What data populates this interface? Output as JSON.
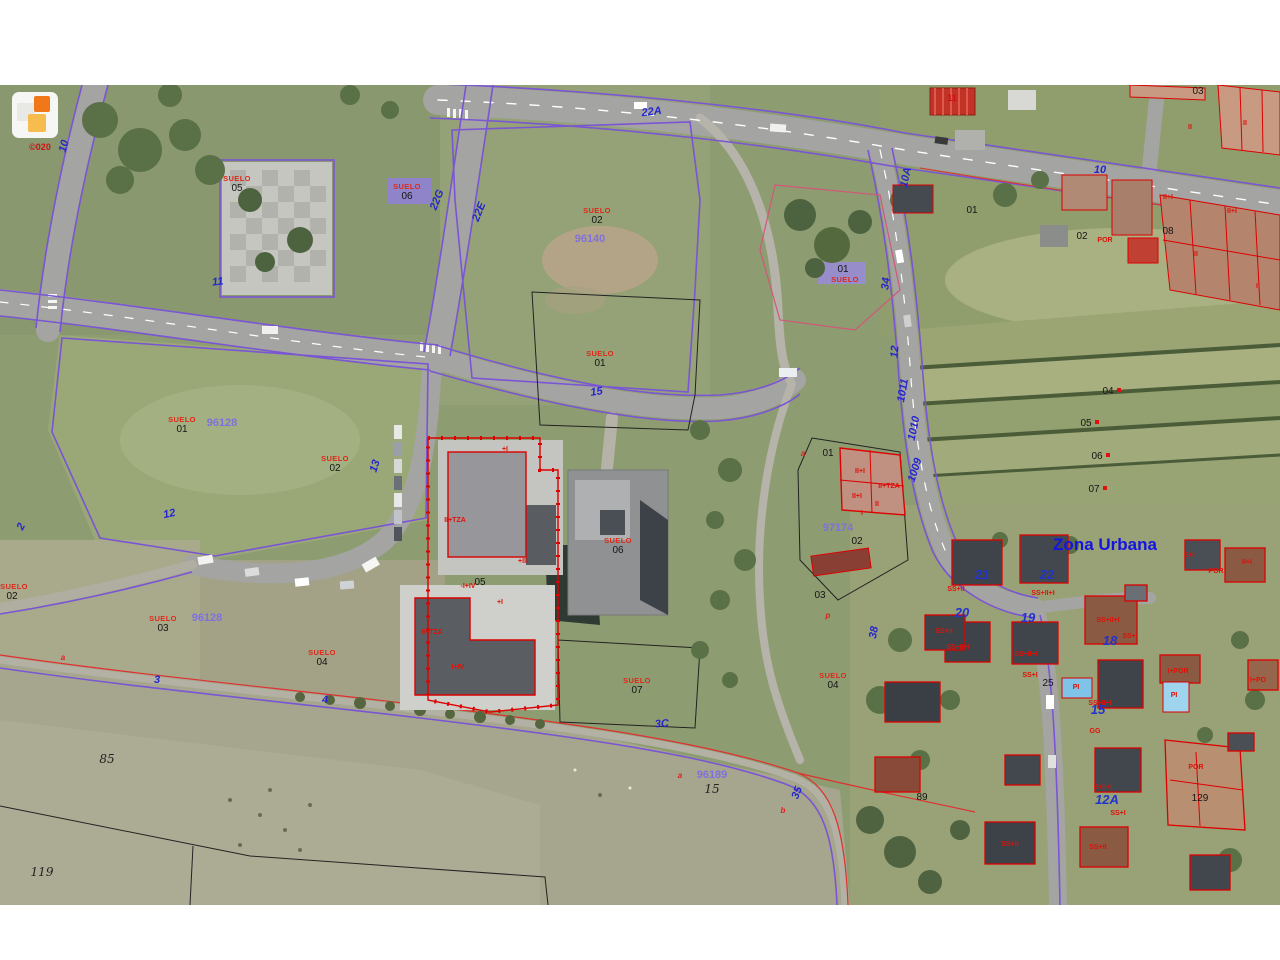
{
  "map_meta": {
    "type": "cadastral-aerial-orthophoto",
    "zone_text": "Zona Urbana",
    "copyright_mark": "©020",
    "colors": {
      "cadastral_line": "#7a55d4",
      "building_outline": "#e00000",
      "road_number": "#2626cc",
      "parcel_number_purple": "#8070dd",
      "suelo_red": "#e02818",
      "zona_urbana_blue": "#1414e0"
    }
  },
  "labels": [
    {
      "t": "©020",
      "x": 40,
      "y": 150,
      "c": "copyright",
      "n": "copyright"
    },
    {
      "t": "SUELO",
      "x": 237,
      "y": 181,
      "c": "suelo"
    },
    {
      "t": "05",
      "x": 237,
      "y": 191,
      "c": "num"
    },
    {
      "t": "SUELO",
      "x": 407,
      "y": 189,
      "c": "suelo"
    },
    {
      "t": "06",
      "x": 407,
      "y": 199,
      "c": "num"
    },
    {
      "t": "SUELO",
      "x": 597,
      "y": 213,
      "c": "suelo"
    },
    {
      "t": "02",
      "x": 597,
      "y": 223,
      "c": "num"
    },
    {
      "t": "SUELO",
      "x": 600,
      "y": 356,
      "c": "suelo"
    },
    {
      "t": "01",
      "x": 600,
      "y": 366,
      "c": "num"
    },
    {
      "t": "SUELO",
      "x": 182,
      "y": 422,
      "c": "suelo"
    },
    {
      "t": "01",
      "x": 182,
      "y": 432,
      "c": "num"
    },
    {
      "t": "SUELO",
      "x": 335,
      "y": 461,
      "c": "suelo"
    },
    {
      "t": "02",
      "x": 335,
      "y": 471,
      "c": "num"
    },
    {
      "t": "SUELO",
      "x": 163,
      "y": 621,
      "c": "suelo"
    },
    {
      "t": "03",
      "x": 163,
      "y": 631,
      "c": "num"
    },
    {
      "t": "SUELO",
      "x": 322,
      "y": 655,
      "c": "suelo"
    },
    {
      "t": "04",
      "x": 322,
      "y": 665,
      "c": "num"
    },
    {
      "t": "SUELO",
      "x": 14,
      "y": 589,
      "c": "suelo"
    },
    {
      "t": "02",
      "x": 12,
      "y": 599,
      "c": "num"
    },
    {
      "t": "SUELO",
      "x": 618,
      "y": 543,
      "c": "suelo"
    },
    {
      "t": "06",
      "x": 618,
      "y": 553,
      "c": "num"
    },
    {
      "t": "SUELO",
      "x": 637,
      "y": 683,
      "c": "suelo"
    },
    {
      "t": "07",
      "x": 637,
      "y": 693,
      "c": "num"
    },
    {
      "t": "SUELO",
      "x": 833,
      "y": 678,
      "c": "suelo"
    },
    {
      "t": "04",
      "x": 833,
      "y": 688,
      "c": "num"
    },
    {
      "t": "01",
      "x": 843,
      "y": 272,
      "c": "num"
    },
    {
      "t": "SUELO",
      "x": 845,
      "y": 282,
      "c": "suelo"
    },
    {
      "t": "96128",
      "x": 222,
      "y": 426,
      "c": "purple"
    },
    {
      "t": "96140",
      "x": 590,
      "y": 242,
      "c": "purple"
    },
    {
      "t": "96128",
      "x": 207,
      "y": 621,
      "c": "purple"
    },
    {
      "t": "97174",
      "x": 838,
      "y": 531,
      "c": "purple"
    },
    {
      "t": "96189",
      "x": 712,
      "y": 778,
      "c": "purple"
    },
    {
      "t": "05",
      "x": 480,
      "y": 585,
      "c": "num"
    },
    {
      "t": "01",
      "x": 828,
      "y": 456,
      "c": "num"
    },
    {
      "t": "02",
      "x": 857,
      "y": 544,
      "c": "num"
    },
    {
      "t": "03",
      "x": 820,
      "y": 598,
      "c": "num"
    },
    {
      "t": "03",
      "x": 1198,
      "y": 94,
      "c": "num"
    },
    {
      "t": "01",
      "x": 972,
      "y": 213,
      "c": "num"
    },
    {
      "t": "02",
      "x": 1082,
      "y": 239,
      "c": "num"
    },
    {
      "t": "08",
      "x": 1168,
      "y": 234,
      "c": "num"
    },
    {
      "t": "25",
      "x": 1048,
      "y": 686,
      "c": "num"
    },
    {
      "t": "89",
      "x": 922,
      "y": 800,
      "c": "num"
    },
    {
      "t": "129",
      "x": 1200,
      "y": 801,
      "c": "num"
    },
    {
      "t": "04",
      "x": 1108,
      "y": 394,
      "c": "num"
    },
    {
      "t": "05",
      "x": 1086,
      "y": 426,
      "c": "num"
    },
    {
      "t": "06",
      "x": 1097,
      "y": 459,
      "c": "num"
    },
    {
      "t": "07",
      "x": 1094,
      "y": 492,
      "c": "num"
    },
    {
      "t": "10",
      "x": 67,
      "y": 147,
      "c": "roadnum",
      "r": -75
    },
    {
      "t": "11",
      "x": 218,
      "y": 285,
      "c": "roadnum",
      "r": -6
    },
    {
      "t": "2",
      "x": 24,
      "y": 528,
      "c": "roadnum",
      "r": -65
    },
    {
      "t": "12",
      "x": 170,
      "y": 517,
      "c": "roadnum",
      "r": -12
    },
    {
      "t": "13",
      "x": 378,
      "y": 467,
      "c": "roadnum",
      "r": -72
    },
    {
      "t": "15",
      "x": 597,
      "y": 395,
      "c": "roadnum",
      "r": -8
    },
    {
      "t": "22A",
      "x": 652,
      "y": 115,
      "c": "roadnum",
      "r": -7
    },
    {
      "t": "22G",
      "x": 440,
      "y": 201,
      "c": "roadnum",
      "r": -68
    },
    {
      "t": "22E",
      "x": 482,
      "y": 213,
      "c": "roadnum",
      "r": -68
    },
    {
      "t": "10A",
      "x": 909,
      "y": 178,
      "c": "roadnum",
      "r": -78
    },
    {
      "t": "34",
      "x": 889,
      "y": 284,
      "c": "roadnum",
      "r": -83
    },
    {
      "t": "12",
      "x": 898,
      "y": 352,
      "c": "roadnum",
      "r": -85
    },
    {
      "t": "1011",
      "x": 906,
      "y": 391,
      "c": "roadnum",
      "r": -80
    },
    {
      "t": "1010",
      "x": 917,
      "y": 429,
      "c": "roadnum",
      "r": -78
    },
    {
      "t": "1009",
      "x": 918,
      "y": 471,
      "c": "roadnum",
      "r": -72
    },
    {
      "t": "38",
      "x": 877,
      "y": 633,
      "c": "roadnum",
      "r": -80
    },
    {
      "t": "3C",
      "x": 662,
      "y": 727,
      "c": "roadnum",
      "r": -4
    },
    {
      "t": "35",
      "x": 800,
      "y": 794,
      "c": "roadnum",
      "r": -68
    },
    {
      "t": "4",
      "x": 325,
      "y": 703,
      "c": "roadnum"
    },
    {
      "t": "3",
      "x": 157,
      "y": 683,
      "c": "roadnum"
    },
    {
      "t": "10",
      "x": 1100,
      "y": 173,
      "c": "roadnum"
    },
    {
      "t": "21",
      "x": 982,
      "y": 579,
      "c": "housenum"
    },
    {
      "t": "22",
      "x": 1047,
      "y": 579,
      "c": "housenum"
    },
    {
      "t": "20",
      "x": 962,
      "y": 617,
      "c": "housenum"
    },
    {
      "t": "19",
      "x": 1028,
      "y": 622,
      "c": "housenum"
    },
    {
      "t": "18",
      "x": 1110,
      "y": 645,
      "c": "housenum"
    },
    {
      "t": "15",
      "x": 1098,
      "y": 714,
      "c": "housenum"
    },
    {
      "t": "12A",
      "x": 1107,
      "y": 804,
      "c": "housenum"
    },
    {
      "t": "85",
      "x": 107,
      "y": 763,
      "c": "blacknum"
    },
    {
      "t": "119",
      "x": 42,
      "y": 876,
      "c": "blacknum"
    },
    {
      "t": "15",
      "x": 712,
      "y": 793,
      "c": "blacknum"
    },
    {
      "t": "Zona Urbana",
      "x": 1105,
      "y": 550,
      "c": "zona",
      "n": "zona-urbana"
    },
    {
      "t": "11",
      "x": 952,
      "y": 101,
      "c": "redbig"
    },
    {
      "t": "II",
      "x": 1190,
      "y": 129,
      "c": "storey"
    },
    {
      "t": "II",
      "x": 1245,
      "y": 125,
      "c": "storey"
    },
    {
      "t": "II+I",
      "x": 1168,
      "y": 199,
      "c": "storey"
    },
    {
      "t": "II+I",
      "x": 1232,
      "y": 213,
      "c": "storey"
    },
    {
      "t": "II",
      "x": 1196,
      "y": 256,
      "c": "storey"
    },
    {
      "t": "II",
      "x": 1258,
      "y": 288,
      "c": "storey"
    },
    {
      "t": "POR",
      "x": 1105,
      "y": 242,
      "c": "storey"
    },
    {
      "t": "II+I",
      "x": 860,
      "y": 473,
      "c": "storey"
    },
    {
      "t": "II+TZA",
      "x": 889,
      "y": 488,
      "c": "storey"
    },
    {
      "t": "II+I",
      "x": 857,
      "y": 498,
      "c": "storey"
    },
    {
      "t": "II",
      "x": 877,
      "y": 506,
      "c": "storey"
    },
    {
      "t": "I",
      "x": 862,
      "y": 515,
      "c": "storey"
    },
    {
      "t": "II+TZA",
      "x": 455,
      "y": 522,
      "c": "storey"
    },
    {
      "t": "+I",
      "x": 505,
      "y": 451,
      "c": "storey"
    },
    {
      "t": "-I+IV",
      "x": 468,
      "y": 588,
      "c": "storey"
    },
    {
      "t": "+III",
      "x": 523,
      "y": 563,
      "c": "storey"
    },
    {
      "t": "II+TZA",
      "x": 432,
      "y": 634,
      "c": "storey"
    },
    {
      "t": "I+IV",
      "x": 458,
      "y": 669,
      "c": "storey"
    },
    {
      "t": "+I",
      "x": 500,
      "y": 604,
      "c": "storey"
    },
    {
      "t": "SS+II",
      "x": 956,
      "y": 591,
      "c": "storey"
    },
    {
      "t": "SS+II+I",
      "x": 1043,
      "y": 595,
      "c": "storey"
    },
    {
      "t": "SS+II+I",
      "x": 958,
      "y": 649,
      "c": "storey"
    },
    {
      "t": "SS+II+I",
      "x": 1026,
      "y": 656,
      "c": "storey"
    },
    {
      "t": "SS+I",
      "x": 1030,
      "y": 677,
      "c": "storey"
    },
    {
      "t": "SS+II+I",
      "x": 1108,
      "y": 622,
      "c": "storey"
    },
    {
      "t": "SS+I",
      "x": 1130,
      "y": 638,
      "c": "storey"
    },
    {
      "t": "S+II",
      "x": 1190,
      "y": 557,
      "c": "storey"
    },
    {
      "t": "POR",
      "x": 1216,
      "y": 573,
      "c": "storey"
    },
    {
      "t": "II+I",
      "x": 1247,
      "y": 564,
      "c": "storey"
    },
    {
      "t": "I+POR",
      "x": 1178,
      "y": 673,
      "c": "storey"
    },
    {
      "t": "I+PO",
      "x": 1258,
      "y": 682,
      "c": "storey"
    },
    {
      "t": "SS+II+I",
      "x": 1100,
      "y": 705,
      "c": "storey"
    },
    {
      "t": "GG",
      "x": 1095,
      "y": 733,
      "c": "storey"
    },
    {
      "t": "S+II+I",
      "x": 1103,
      "y": 789,
      "c": "storey"
    },
    {
      "t": "SS+I",
      "x": 1118,
      "y": 815,
      "c": "storey"
    },
    {
      "t": "POR",
      "x": 1196,
      "y": 769,
      "c": "storey"
    },
    {
      "t": "SS+II",
      "x": 1010,
      "y": 846,
      "c": "storey"
    },
    {
      "t": "SS+II",
      "x": 1098,
      "y": 849,
      "c": "storey"
    },
    {
      "t": "SS+II",
      "x": 944,
      "y": 633,
      "c": "storey"
    },
    {
      "t": "PI",
      "x": 1174,
      "y": 697,
      "c": "storey"
    },
    {
      "t": "PI",
      "x": 1076,
      "y": 689,
      "c": "storey"
    },
    {
      "t": "a",
      "x": 680,
      "y": 778,
      "c": "reda"
    },
    {
      "t": "b",
      "x": 783,
      "y": 813,
      "c": "reda"
    },
    {
      "t": "p",
      "x": 828,
      "y": 618,
      "c": "reda"
    },
    {
      "t": "a",
      "x": 63,
      "y": 660,
      "c": "reda"
    },
    {
      "t": "a",
      "x": 803,
      "y": 456,
      "c": "reda"
    }
  ]
}
